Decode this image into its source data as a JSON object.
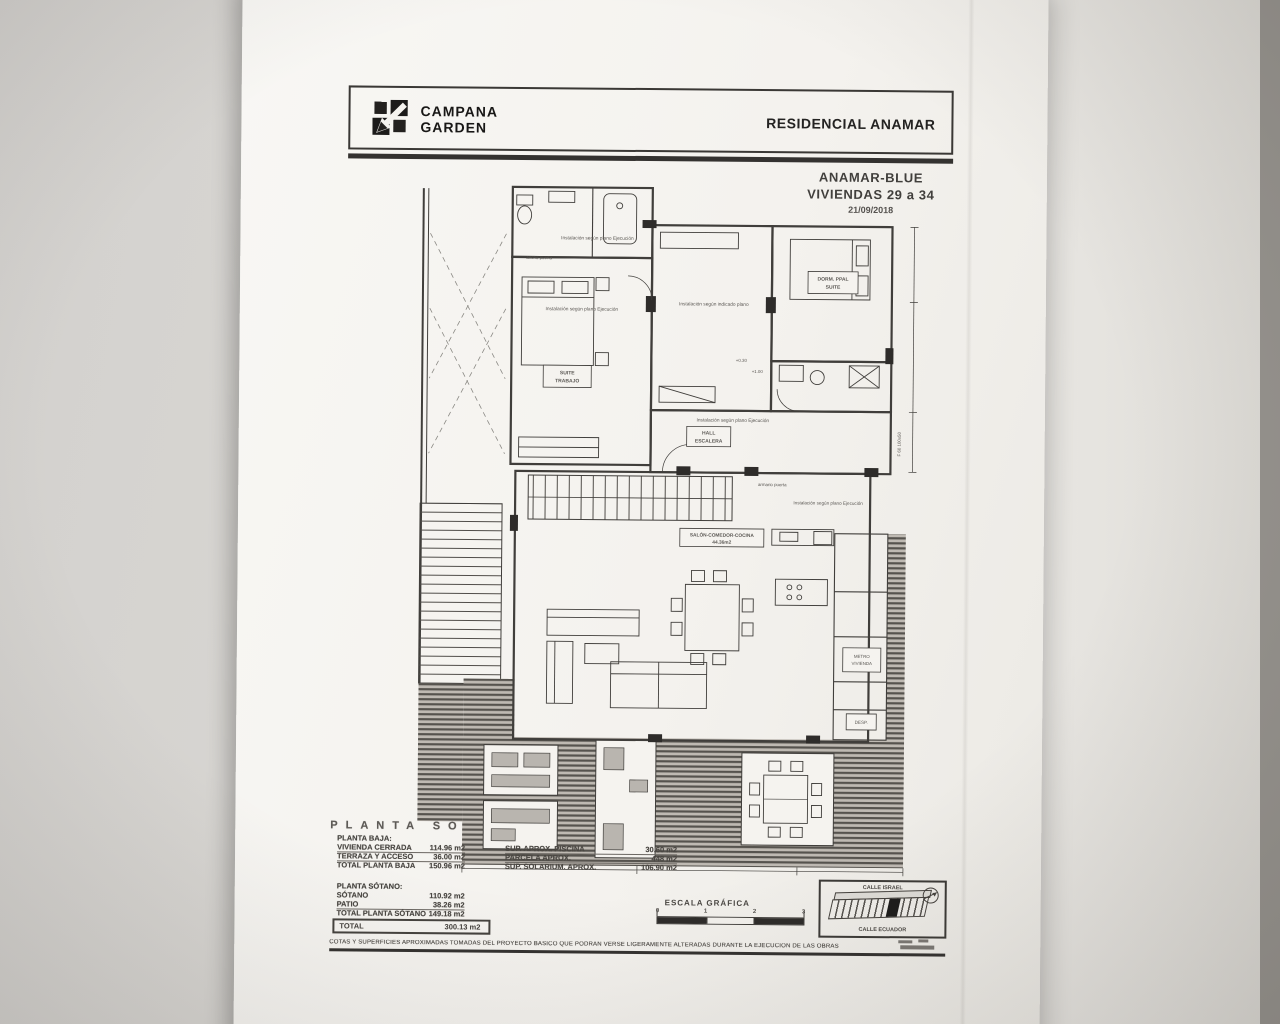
{
  "header": {
    "brand_line1": "CAMPANA",
    "brand_line2": "GARDEN",
    "project": "RESIDENCIAL ANAMAR"
  },
  "title_block": {
    "name": "ANAMAR-BLUE",
    "units": "VIVIENDAS 29 a 34",
    "date": "21/09/2018"
  },
  "plan": {
    "big_heading": "PLANTA SÓ",
    "notes": {
      "install_plano_ejecucion": "Instalación según plano Ejecución",
      "install_indicado": "Instalación según indicado plano",
      "ancho_puerta": "ancho puerta",
      "armario_puerta": "armario puerta"
    },
    "rooms": {
      "suite_line1": "SUITE",
      "suite_line2": "TRABAJO",
      "hall_line1": "HALL",
      "hall_line2": "ESCALERA",
      "dorm_line1": "DORM. PPAL",
      "dorm_line2": "SUITE",
      "salon_line1": "SALÓN-COMEDOR-COCINA",
      "salon_line2": "44.36m2",
      "metro_line1": "METRO",
      "metro_line2": "VIVIENDA",
      "desp": "DESP.",
      "fab": "F 60 100x50"
    },
    "levels": {
      "l30": "+0.30",
      "l100": "+1.00"
    }
  },
  "areas": {
    "planta_baja": {
      "heading": "PLANTA BAJA:",
      "rows": [
        {
          "label": "VIVIENDA CERRADA",
          "value": "114.96 m2"
        },
        {
          "label": "TERRAZA Y ACCESO",
          "value": "36.00 m2"
        },
        {
          "label": "TOTAL PLANTA BAJA",
          "value": "150.96 m2"
        }
      ]
    },
    "aux": {
      "rows": [
        {
          "label": "SUP. APROX. PISCINA",
          "value": "30.60 m2"
        },
        {
          "label": "PARCELA APROX.",
          "value": "448 m2"
        },
        {
          "label": "SUP. SOLARIUM. APROX.",
          "value": "106.90 m2"
        }
      ]
    },
    "planta_sotano": {
      "heading": "PLANTA SÓTANO:",
      "rows": [
        {
          "label": "SÓTANO",
          "value": "110.92 m2"
        },
        {
          "label": "PATIO",
          "value": "38.26 m2"
        },
        {
          "label": "TOTAL PLANTA SÓTANO",
          "value": "149.18 m2"
        }
      ]
    },
    "total": {
      "label": "TOTAL",
      "value": "300.13 m2"
    }
  },
  "scale_bar": {
    "label": "ESCALA GRÁFICA",
    "ticks": [
      "0",
      "1",
      "2",
      "3"
    ]
  },
  "location_key": {
    "street_top": "CALLE ISRAEL",
    "street_bottom": "CALLE ECUADOR"
  },
  "footer": {
    "disclaimer": "COTAS Y SUPERFICIES APROXIMADAS TOMADAS DEL PROYECTO BÁSICO QUE PODRÁN VERSE LIGERAMENTE ALTERADAS DURANTE LA EJECUCIÓN DE LAS OBRAS"
  }
}
